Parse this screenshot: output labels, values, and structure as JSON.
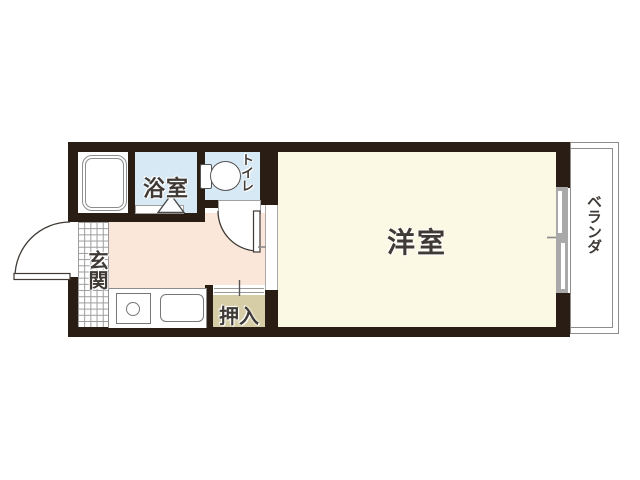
{
  "floorplan": {
    "type": "apartment-floor-plan",
    "rooms": {
      "living": {
        "label": "洋室"
      },
      "bath": {
        "label": "浴室"
      },
      "toilet": {
        "label": "トイレ"
      },
      "entrance": {
        "label": "玄関"
      },
      "closet": {
        "label": "押入"
      },
      "veranda": {
        "label": "ベランダ"
      }
    },
    "colors": {
      "wall": "#2a1d14",
      "living_room": "#fbf8e3",
      "kitchen": "#fae7da",
      "wet_area": "#d7e9f4",
      "closet_fill": "#d6cda6",
      "tile_line": "#9a9a9a",
      "outline": "#8d8d8d",
      "frame_gray": "#a9a9a9",
      "text": "#3f3a36"
    }
  }
}
